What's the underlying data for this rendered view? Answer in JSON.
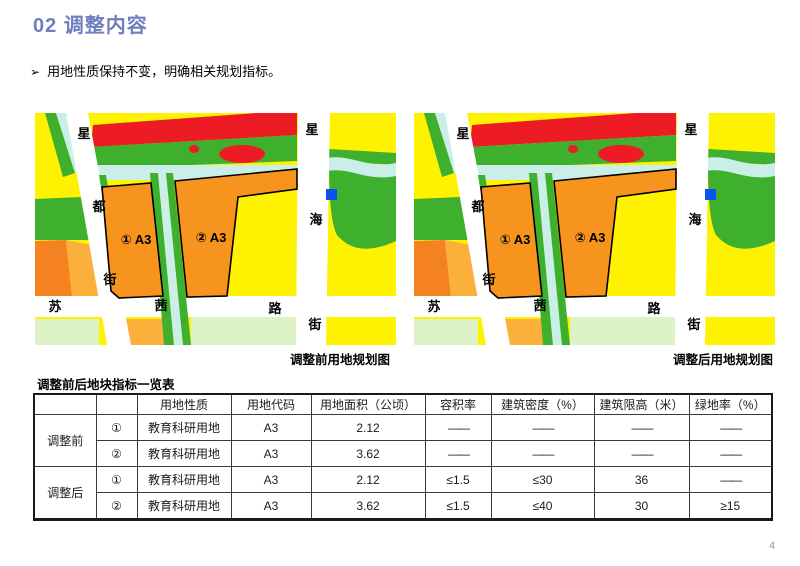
{
  "header": {
    "title": "02 调整内容"
  },
  "bullet": {
    "marker": "➢",
    "text": "用地性质保持不变，明确相关规划指标。"
  },
  "maps": {
    "caption_before": "调整前用地规划图",
    "caption_after": "调整后用地规划图",
    "labels": {
      "road_left": [
        "星",
        "都",
        "街"
      ],
      "road_right": [
        "星",
        "海",
        "街"
      ],
      "road_bottom": [
        "苏",
        "茜",
        "路"
      ],
      "parcel1": "① A3",
      "parcel2": "② A3"
    },
    "colors": {
      "yellow": "#FFF200",
      "pale": "#DDF2C6",
      "amber": "#FBB03B",
      "green": "#3FAF2E",
      "orange2": "#F58220",
      "red": "#ED1C24",
      "water": "#C9EFE8",
      "road": "#FFFFFF",
      "a3": "#F7941D",
      "blue": "#0C52EE"
    }
  },
  "table": {
    "title": "调整前后地块指标一览表",
    "headers": [
      "用地性质",
      "用地代码",
      "用地面积（公顷）",
      "容积率",
      "建筑密度（%）",
      "建筑限高（米）",
      "绿地率（%）"
    ],
    "groups": [
      {
        "label": "调整前",
        "rows": [
          {
            "no": "①",
            "nature": "教育科研用地",
            "code": "A3",
            "area": "2.12",
            "far": "——",
            "density": "——",
            "height": "——",
            "green": "——"
          },
          {
            "no": "②",
            "nature": "教育科研用地",
            "code": "A3",
            "area": "3.62",
            "far": "——",
            "density": "——",
            "height": "——",
            "green": "——"
          }
        ]
      },
      {
        "label": "调整后",
        "rows": [
          {
            "no": "①",
            "nature": "教育科研用地",
            "code": "A3",
            "area": "2.12",
            "far": "≤1.5",
            "density": "≤30",
            "height": "36",
            "green": "——"
          },
          {
            "no": "②",
            "nature": "教育科研用地",
            "code": "A3",
            "area": "3.62",
            "far": "≤1.5",
            "density": "≤40",
            "height": "30",
            "green": "≥15"
          }
        ]
      }
    ]
  },
  "page": {
    "number": "4"
  }
}
